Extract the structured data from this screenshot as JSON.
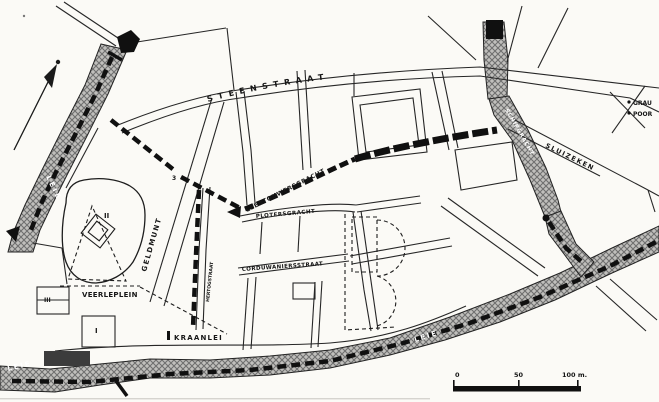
{
  "map": {
    "streets": {
      "steenstraat": "STEENSTRAAT",
      "leertouwersgracht": "LEERTOUWERSGRACHT",
      "plotersgracht": "PLOTERSGRACHT",
      "corduwaniersstraat": "CORDUWANIERSSTRAAT",
      "geldmunt": "GELDMUNT",
      "hertogstraat": "HERTOGSTRAAT",
      "kraanlei": "KRAANLEI",
      "sluizeken": "SLUIZEKEN",
      "veerleplein": "VEERLEPLEIN"
    },
    "waterways": {
      "schipgracht": "SCHIPGRACHT",
      "leie_upper_left": "LEIE",
      "leie_lower_left": "LEIE",
      "leie_lower_right": "LEIE"
    },
    "gates": {
      "grauwpoort_line1": "GRAU",
      "grauwpoort_line2": "POOR",
      "gate_number_3": "3"
    },
    "sites": {
      "numeral_1": "I",
      "numeral_2": "II",
      "numeral_3": "III"
    },
    "scale_bar": {
      "zero": "0",
      "fifty": "50",
      "hundred": "100 m."
    },
    "colors": {
      "ink": "#161616",
      "paper": "#fbfaf6",
      "water_fill": "#c0bfbc",
      "water_hatch": "#6f6f6f"
    }
  }
}
